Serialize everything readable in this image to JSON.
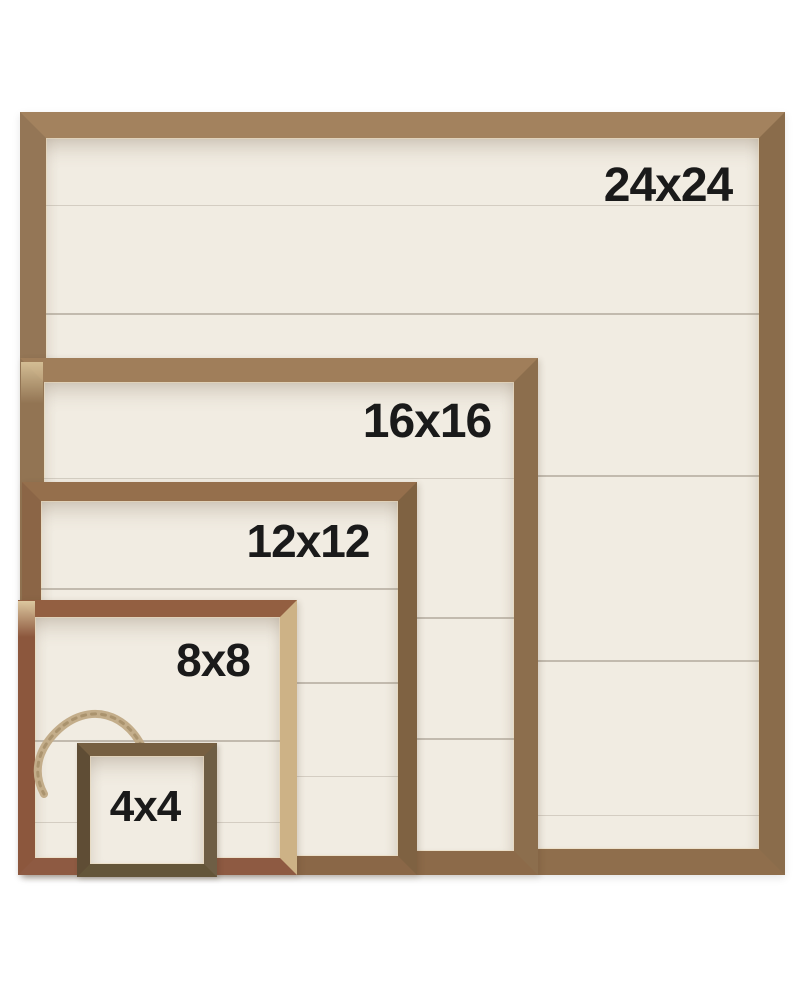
{
  "photo": {
    "description": "Five nested rustic wood picture frames with white shiplap backing, corner-stacked for size comparison",
    "frames": [
      {
        "label": "24x24"
      },
      {
        "label": "16x16"
      },
      {
        "label": "12x12"
      },
      {
        "label": "8x8"
      },
      {
        "label": "4x4"
      }
    ],
    "colors": {
      "background": "#ffffff",
      "panel_cream": "#f1ece2",
      "seam_gray": "#8a7f6e",
      "walnut_brown": "#9a7b59",
      "mahogany_red": "#8e5c42",
      "blond_wood": "#d4ba8e",
      "dark_olive_wood": "#6d5c42",
      "twine_tan": "#c3ad8a",
      "label_black": "#1a1a1a"
    }
  }
}
